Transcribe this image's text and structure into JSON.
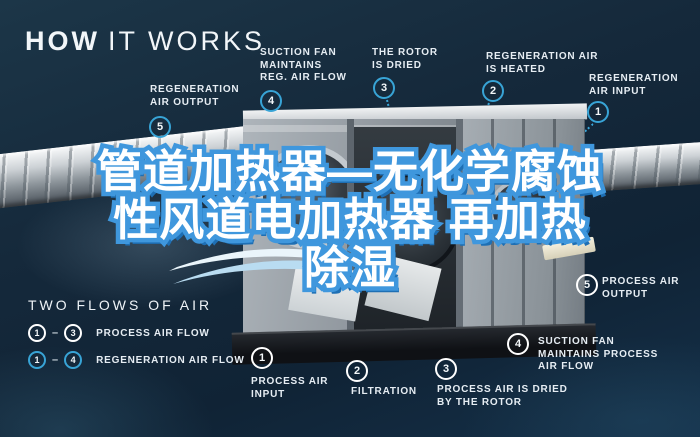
{
  "header": {
    "title_bold": "HOW",
    "title_rest": "IT WORKS"
  },
  "overlay_text": {
    "line1": "管道加热器—无化学腐蚀",
    "line2": "性风道电加热器 再加热",
    "line3": "除湿"
  },
  "callouts": {
    "regeneration": [
      {
        "num": "1",
        "text": "REGENERATION\nAIR INPUT"
      },
      {
        "num": "2",
        "text": "REGENERATION AIR\nIS HEATED"
      },
      {
        "num": "3",
        "text": "THE ROTOR\nIS DRIED"
      },
      {
        "num": "4",
        "text": "SUCTION FAN\nMAINTAINS\nREG. AIR FLOW"
      },
      {
        "num": "5",
        "text": "REGENERATION\nAIR OUTPUT"
      }
    ],
    "process": [
      {
        "num": "1",
        "text": "PROCESS AIR\nINPUT"
      },
      {
        "num": "2",
        "text": "FILTRATION"
      },
      {
        "num": "3",
        "text": "PROCESS AIR IS DRIED\nBY THE ROTOR"
      },
      {
        "num": "4",
        "text": "SUCTION FAN\nMAINTAINS PROCESS\nAIR FLOW"
      },
      {
        "num": "5",
        "text": "PROCESS AIR\nOUTPUT"
      }
    ]
  },
  "legend": {
    "title": "TWO FLOWS OF AIR",
    "separator": "–",
    "rows": [
      {
        "from": "1",
        "to": "3",
        "label": "PROCESS AIR FLOW",
        "style": "process"
      },
      {
        "from": "1",
        "to": "4",
        "label": "REGENERATION AIR FLOW",
        "style": "regeneration"
      }
    ]
  },
  "colors": {
    "background": "#15293b",
    "accent_blue": "#38a4d6",
    "process_white": "#eef3f7",
    "label_text": "#e6edf3",
    "overlay_fill": "#ffffff",
    "overlay_stroke": "#3f97dd",
    "overlay_shadow": "#1e6fb4"
  }
}
